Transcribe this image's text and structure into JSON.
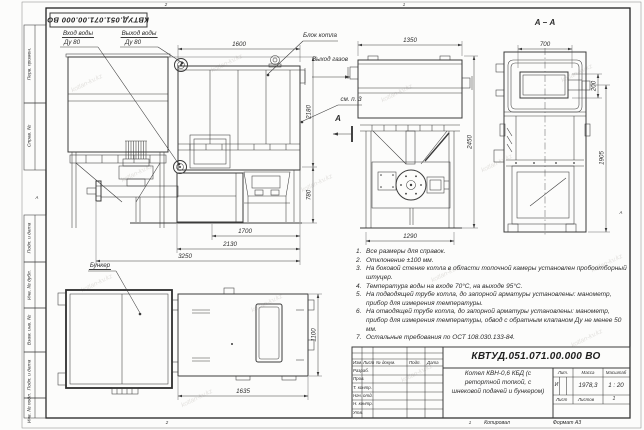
{
  "page": {
    "doc_code_top": "КВТУД.051.071.00.000 ВО",
    "zone_top_left": "2",
    "zone_top_right": "1",
    "zone_bottom_left": "2",
    "zone_bottom_right": "1",
    "fold_left": "А",
    "fold_right": "А",
    "copied": "Копировал",
    "format": "Формат А3",
    "watermark": "kotlan-kv.kz"
  },
  "margin": {
    "top": [
      "Перв. примен.",
      "Справ. №"
    ],
    "bottom": [
      "Подп. и дата",
      "Инв. № дубл.",
      "Взам. инв. №",
      "Подп. и дата",
      "Инв. № подл."
    ]
  },
  "labels": {
    "water_in_l1": "Вход воды",
    "water_in_l2": "Ду 80",
    "water_out_l1": "Выход воды",
    "water_out_l2": "Ду 80",
    "boiler_block": "Блок котла",
    "gas_out": "Выход газов",
    "see_note": "см. п. 3",
    "section_letter": "А",
    "section_view_title": "А – А",
    "bunker": "Бункер"
  },
  "dims": {
    "front_top": "1600",
    "front_h1": "2180",
    "front_h2": "780",
    "front_b1": "1700",
    "front_b2": "2130",
    "front_b3": "3250",
    "side_top": "1350",
    "side_h": "2450",
    "side_b": "1290",
    "aa_top": "700",
    "aa_h1": "200",
    "aa_h2": "1905",
    "plan_b": "1635",
    "plan_h": "1100"
  },
  "notes": {
    "items": [
      {
        "num": "1.",
        "text": "Все размеры для справок."
      },
      {
        "num": "2.",
        "text": "Отклонение ±100 мм."
      },
      {
        "num": "3.",
        "text": "На боковой стенке котла в области топочной камеры установлен пробоотборный штуцер."
      },
      {
        "num": "4.",
        "text": "Температура воды на входе 70°С, на выходе 95°С."
      },
      {
        "num": "5.",
        "text": "На подводящей трубе котла, до запорной арматуры установлены: манометр, прибор для измерения температуры."
      },
      {
        "num": "6.",
        "text": "На отводящей трубе котла, до запорной арматуры установлены: манометр, прибор для измерения температуры, обвод с обратным клапаном Ду не менее 50 мм."
      },
      {
        "num": "7.",
        "text": "Остальные требования по ОСТ 108.030.133-84."
      }
    ]
  },
  "title_block": {
    "doc_number": "КВТУД.051.071.00.000 ВО",
    "title_l1": "Котел КВН-0,6 КБД (с",
    "title_l2": "ретортной топкой, с",
    "title_l3": "шнековой подачей и бункером)",
    "cols": {
      "izm": "Изм.",
      "list": "Лист",
      "doc": "№ докум.",
      "podp": "Подп.",
      "data": "Дата"
    },
    "rows": [
      "Разраб.",
      "Пров.",
      "Т. контр.",
      "Нач. отд.",
      "Н. контр.",
      "Утв."
    ],
    "lit_label": "Лит.",
    "lit_value": "И",
    "mass_label": "Масса",
    "mass_value": "1978,3",
    "scale_label": "Масштаб",
    "scale_value": "1 : 20",
    "sheet_label": "Лист",
    "sheets_label": "Листов",
    "sheets_value": "1"
  }
}
